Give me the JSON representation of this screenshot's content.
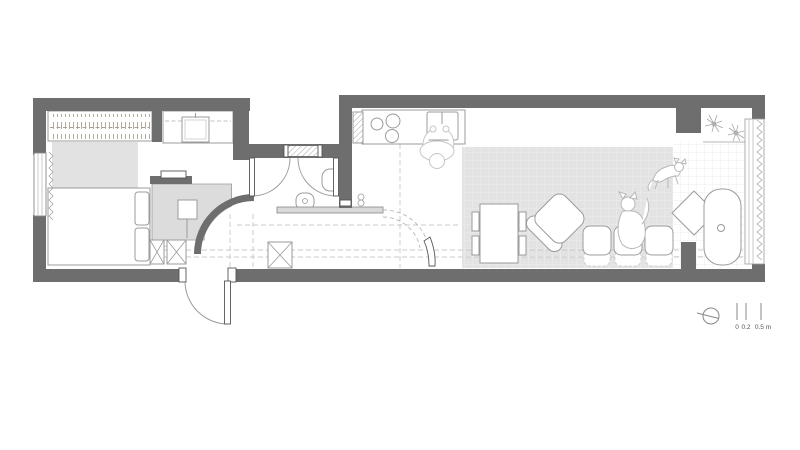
{
  "colors": {
    "wall": "#6e6e6e",
    "floor": "#ffffff",
    "rug": "#e3e3e3",
    "shower_floor": "#dcdcdc",
    "ledge": "#d9d9d9",
    "line": "#9b9b9b",
    "line_light": "#c8c8c8",
    "sketch": "#c6c6c6",
    "curtain": "#beb6ae",
    "wardrobe_tick": "#aba195",
    "text": "#555555"
  },
  "scale_bar": {
    "tick_labels": [
      "0",
      "0.2",
      "0.5 m"
    ]
  },
  "icons": {
    "compass": "compass-icon",
    "plants": "plant-icon",
    "cats": "cat-icon"
  }
}
